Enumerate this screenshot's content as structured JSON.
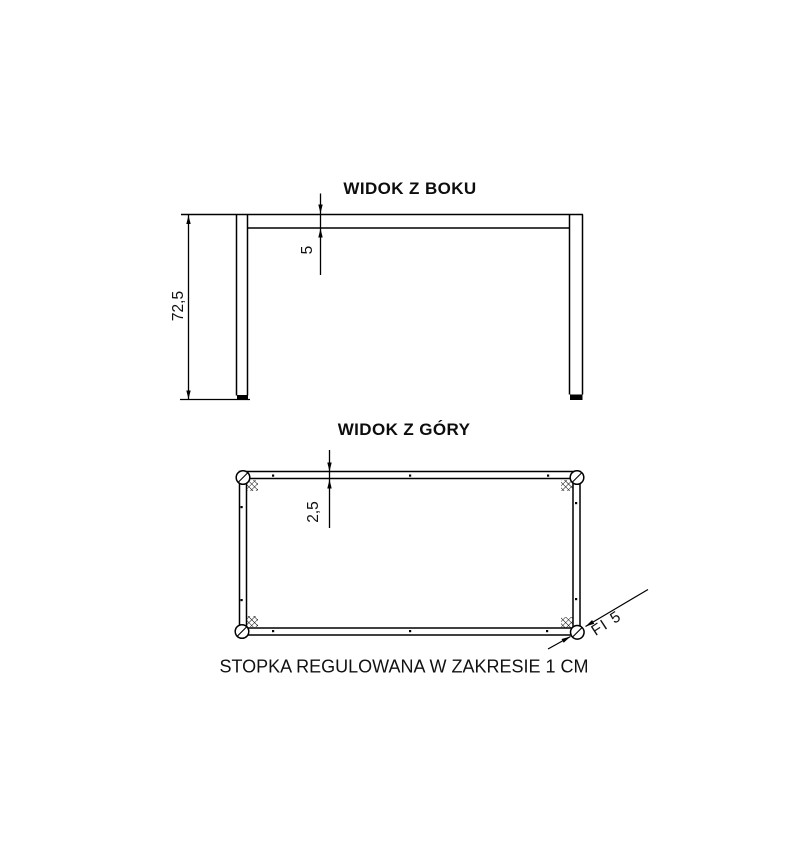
{
  "drawing": {
    "background_color": "#ffffff",
    "line_color": "#000000"
  },
  "side_view": {
    "title": "WIDOK Z BOKU",
    "height_label": "72,5",
    "top_thickness_label": "5"
  },
  "top_view": {
    "title": "WIDOK Z GÓRY",
    "frame_width_label": "2,5",
    "foot_diameter_label": "FI 5"
  },
  "footer": {
    "note": "STOPKA REGULOWANA W ZAKRESIE 1 CM"
  }
}
